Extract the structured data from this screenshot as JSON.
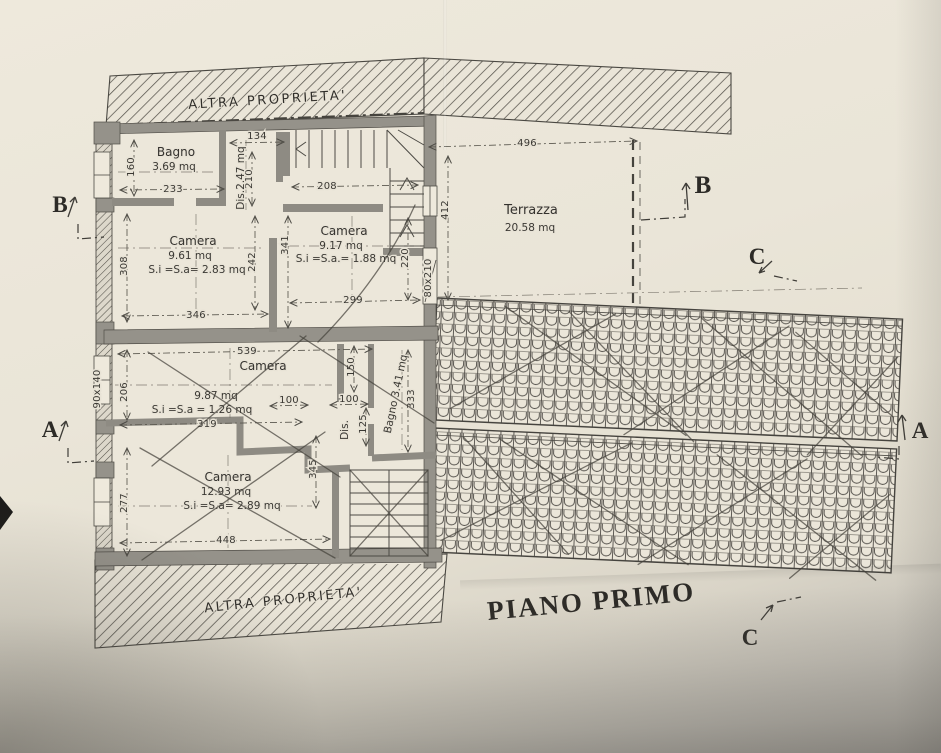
{
  "page": {
    "title": "PIANO PRIMO"
  },
  "annotations": {
    "other_property_top": "ALTRA PROPRIETA'",
    "other_property_bottom": "ALTRA PROPRIETA'"
  },
  "rooms": {
    "bagno_top": {
      "name": "Bagno",
      "area": "3.69 mq"
    },
    "dis_top": {
      "label": "Dis.2.47 mq"
    },
    "camera_nw": {
      "name": "Camera",
      "area": "9.61 mq",
      "net": "S.i =S.a= 2.83 mq"
    },
    "camera_ne": {
      "name": "Camera",
      "area": "9.17 mq",
      "net": "S.i =S.a.= 1.88 mq"
    },
    "terrazza": {
      "name": "Terrazza",
      "area": "20.58 mq"
    },
    "camera_mid": {
      "name": "Camera",
      "area": "9.87 mq",
      "net": "S.i =S.a = 1.26 mq"
    },
    "dis_mid": {
      "label": "Dis."
    },
    "bagno_mid": {
      "label": "Bagno 3.41 mq"
    },
    "camera_s": {
      "name": "Camera",
      "area": "12.93 mq",
      "net": "S.i =S.a= 2.89 mq"
    }
  },
  "dimensions": {
    "d134": "134",
    "d210": "210",
    "d208": "208",
    "d233": "233",
    "d160": "160",
    "d308": "308",
    "d242": "242",
    "d346": "346",
    "d341": "341",
    "d299": "299",
    "d220": "220",
    "d496": "496",
    "d412": "412",
    "d539": "539",
    "d206": "206",
    "d319": "319",
    "d150": "150",
    "d100a": "100",
    "d100b": "100",
    "d125": "125",
    "d333": "333",
    "d345": "345",
    "d277": "277",
    "d448": "448"
  },
  "openings": {
    "window_left": "90x140",
    "door_right": "80x210"
  },
  "section_markers": {
    "b_left": "B",
    "a_left": "A",
    "b_right": "B",
    "c_right": "C",
    "a_right": "A",
    "c_bottom": "C"
  },
  "colors": {
    "paper": "#e9e4d7",
    "ink": "#3c3a34",
    "wall_fill": "#95928a"
  }
}
